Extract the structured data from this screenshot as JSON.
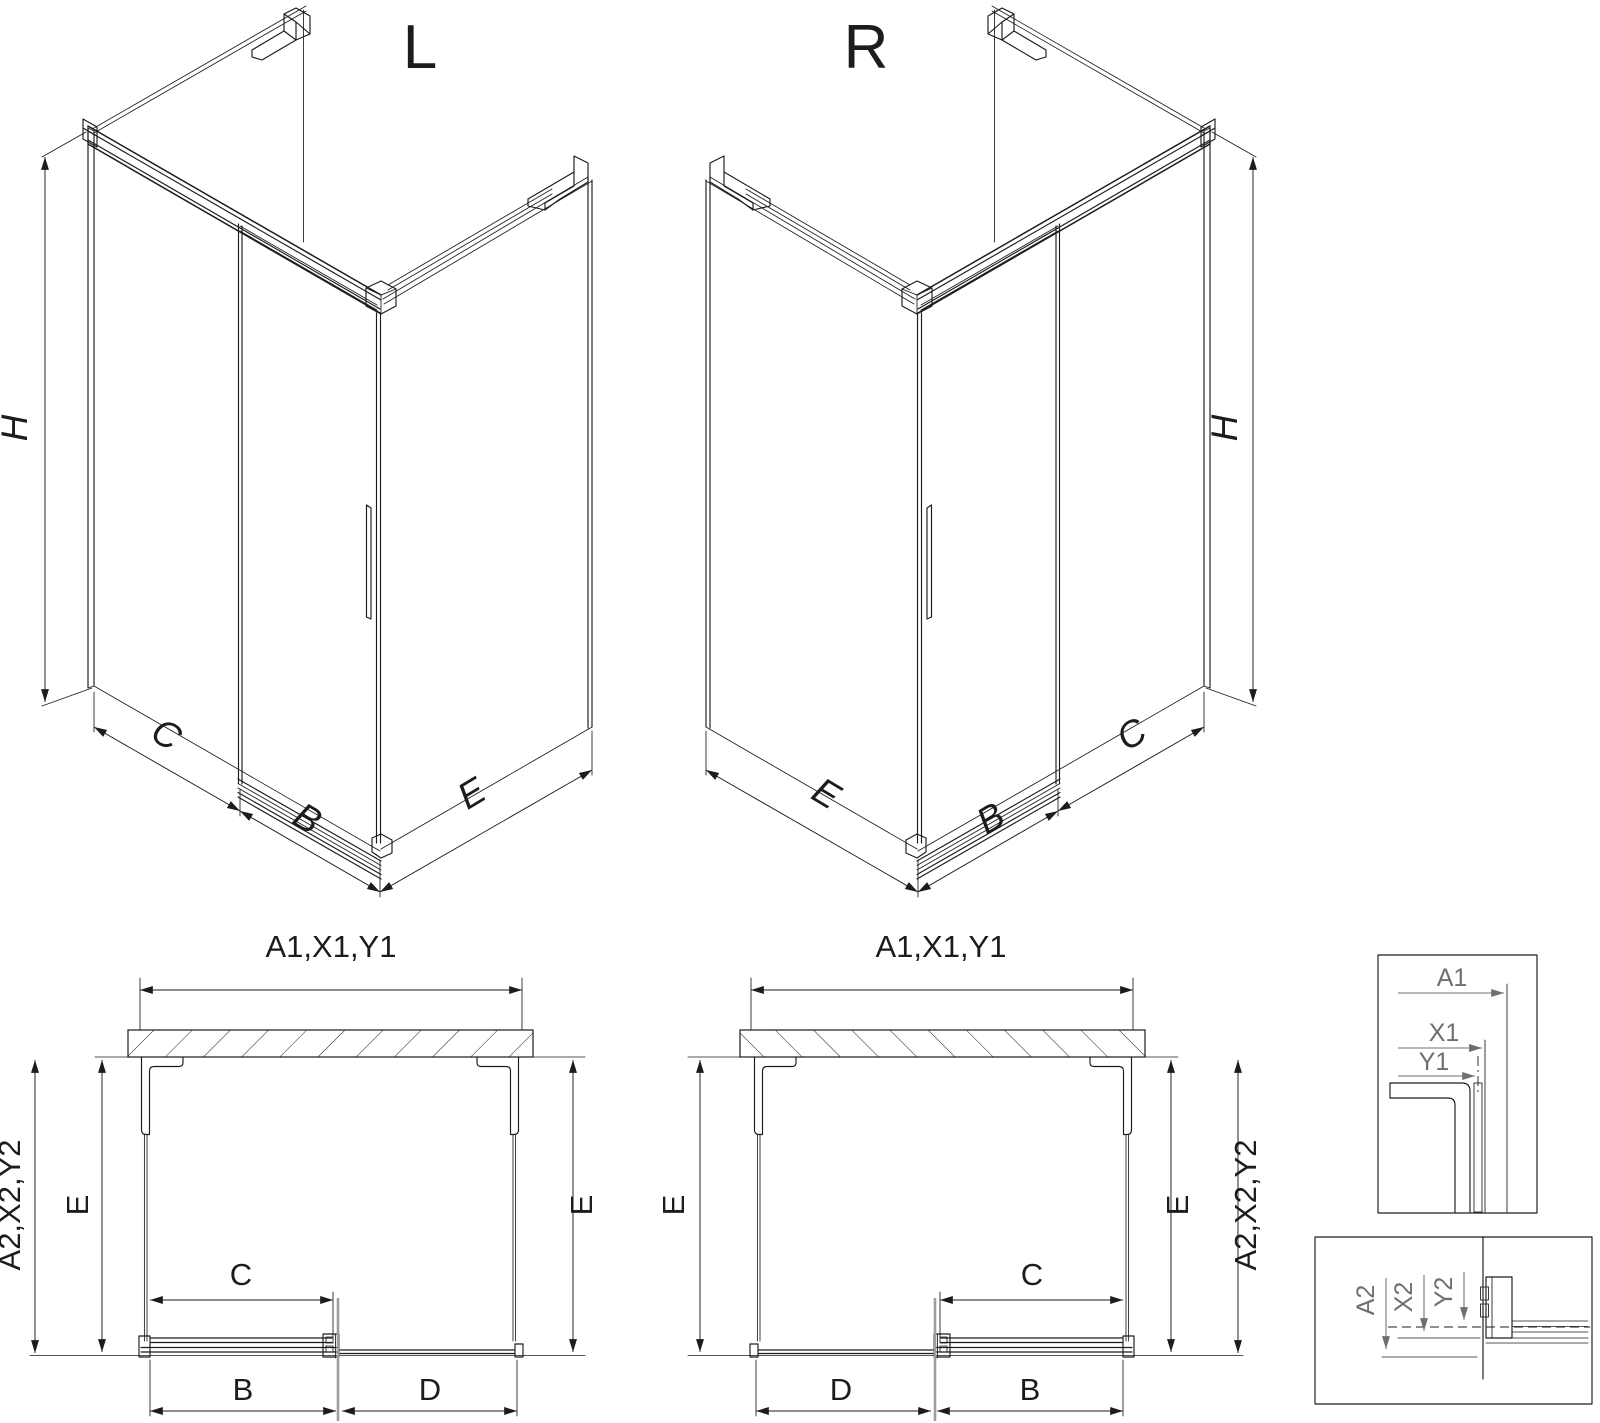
{
  "views": {
    "iso_left": {
      "variant": "L",
      "height_dim": "H",
      "panel_dim": "C",
      "door_dim": "B",
      "side_dim": "E"
    },
    "iso_right": {
      "variant": "R",
      "height_dim": "H",
      "panel_dim": "C",
      "door_dim": "B",
      "side_dim": "E"
    },
    "plan_left": {
      "width_dims": "A1,X1,Y1",
      "depth_dims": "A2,X2,Y2",
      "side_left": "E",
      "side_right": "E",
      "opening_dim": "C",
      "door_dim": "B",
      "fixed_dim": "D"
    },
    "plan_right": {
      "width_dims": "A1,X1,Y1",
      "depth_dims": "A2,X2,Y2",
      "side_left": "E",
      "side_right": "E",
      "opening_dim": "C",
      "door_dim": "B",
      "fixed_dim": "D"
    },
    "detail_glass_section": {
      "dim_a": "A1",
      "dim_x": "X1",
      "dim_y": "Y1"
    },
    "detail_door_section": {
      "dim_a": "A2",
      "dim_x": "X2",
      "dim_y": "Y2"
    }
  },
  "colors": {
    "ink": "#1c1c1c",
    "dim": "#6f6f6f",
    "faint": "#9e9e9e",
    "bg": "#ffffff"
  }
}
